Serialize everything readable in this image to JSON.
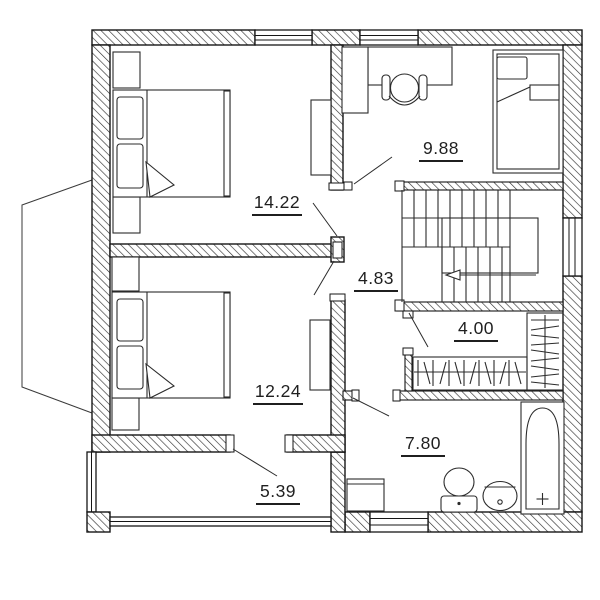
{
  "plan": {
    "type": "floor-plan",
    "units": "m2",
    "rooms": [
      {
        "id": "bedroom-1",
        "label": "14.22"
      },
      {
        "id": "kids-room",
        "label": "9.88"
      },
      {
        "id": "hallway",
        "label": "4.83"
      },
      {
        "id": "wardrobe",
        "label": "4.00"
      },
      {
        "id": "bedroom-2",
        "label": "12.24"
      },
      {
        "id": "bathroom",
        "label": "7.80"
      },
      {
        "id": "balcony",
        "label": "5.39"
      }
    ],
    "colors": {
      "line": "#1b1b1b",
      "background": "#ffffff"
    }
  }
}
